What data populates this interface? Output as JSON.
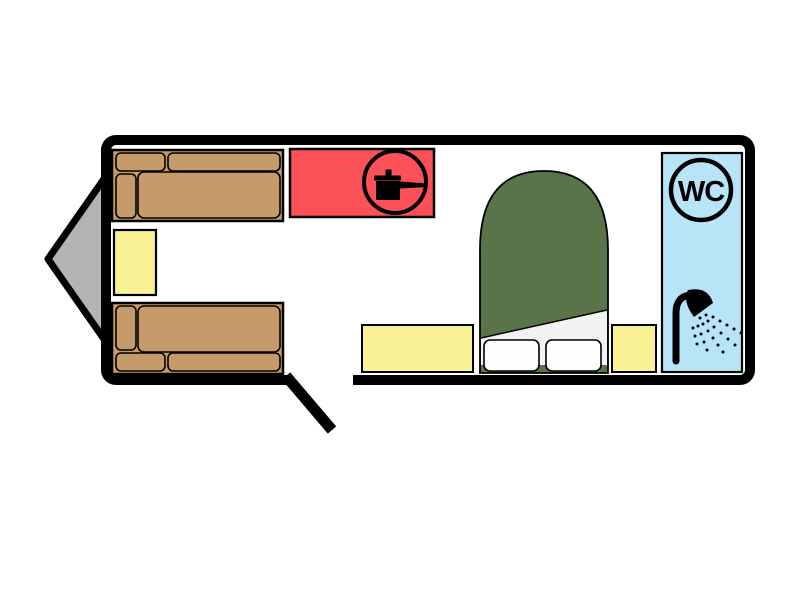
{
  "labels": {
    "wc": "WC"
  },
  "colors": {
    "background": "#ffffff",
    "outline": "#000000",
    "hitch": "#b4b4b4",
    "sofa": "#c69b6b",
    "table": "#f8f295",
    "kitchen": "#fc5158",
    "bed": "#5a744a",
    "sheet": "#f2f2f2",
    "pillow": "#fefefe",
    "bathroom": "#b7e4f7",
    "icon": "#000000"
  },
  "icons": {
    "kitchen": "cooking-pot-icon",
    "toilet": "wc-roundel-icon",
    "shower": "shower-icon"
  }
}
